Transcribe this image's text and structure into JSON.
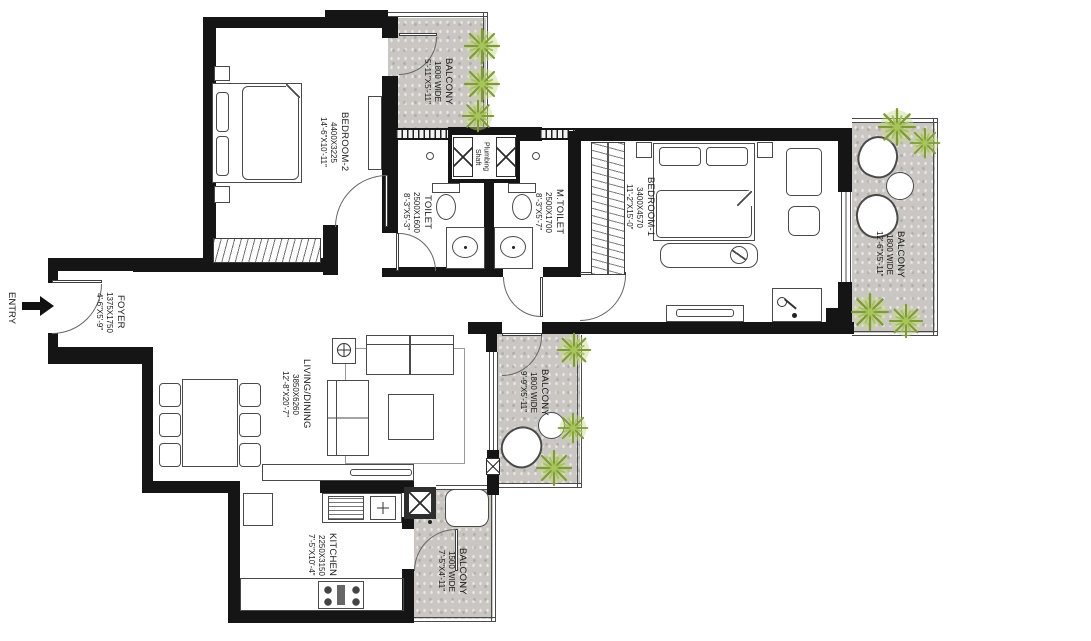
{
  "entry": {
    "label": "ENTRY"
  },
  "rooms": {
    "bedroom2": {
      "name": "BEDROOM-2",
      "mm": "4400X3225",
      "ft": "14'-6\"X10'-11\""
    },
    "balcony_top": {
      "name": "BALCONY",
      "mm": "1800 WIDE",
      "ft": "5'-11\"X5'-11\""
    },
    "toilet": {
      "name": "TOILET",
      "mm": "2500X1600",
      "ft": "8'-3\"X5'-3\""
    },
    "shaft": {
      "line1": "Plumbing",
      "line2": "Shaft"
    },
    "mtoilet": {
      "name": "M.TOILET",
      "mm": "2500X1700",
      "ft": "8'-3\"X5'-7\""
    },
    "bedroom1": {
      "name": "BEDROOM-1",
      "mm": "3400X4570",
      "ft": "11'-2\"X15'-0\""
    },
    "balcony_right": {
      "name": "BALCONY",
      "mm": "1800 WIDE",
      "ft": "12'-6\"X5'-11\""
    },
    "foyer": {
      "name": "FOYER",
      "mm": "1375X1750",
      "ft": "4'-6\"X5'-9\""
    },
    "living": {
      "name": "LIVING/DINING",
      "mm": "3850X6260",
      "ft": "12'-8\"X20'-7\""
    },
    "balcony_mid": {
      "name": "BALCONY",
      "mm": "1800 WIDE",
      "ft": "9'-9\"X5'-11\""
    },
    "kitchen": {
      "name": "KITCHEN",
      "mm": "2250X3150",
      "ft": "7'-5\"X10'-4\""
    },
    "balcony_bottom": {
      "name": "BALCONY",
      "mm": "1500 WIDE",
      "ft": "7'-5\"X4'-11\""
    }
  },
  "colors": {
    "wall": "#151515",
    "balcony_fill": "#cac7c3",
    "tree_green": "#7d9c38",
    "line": "#4a4a4a"
  }
}
